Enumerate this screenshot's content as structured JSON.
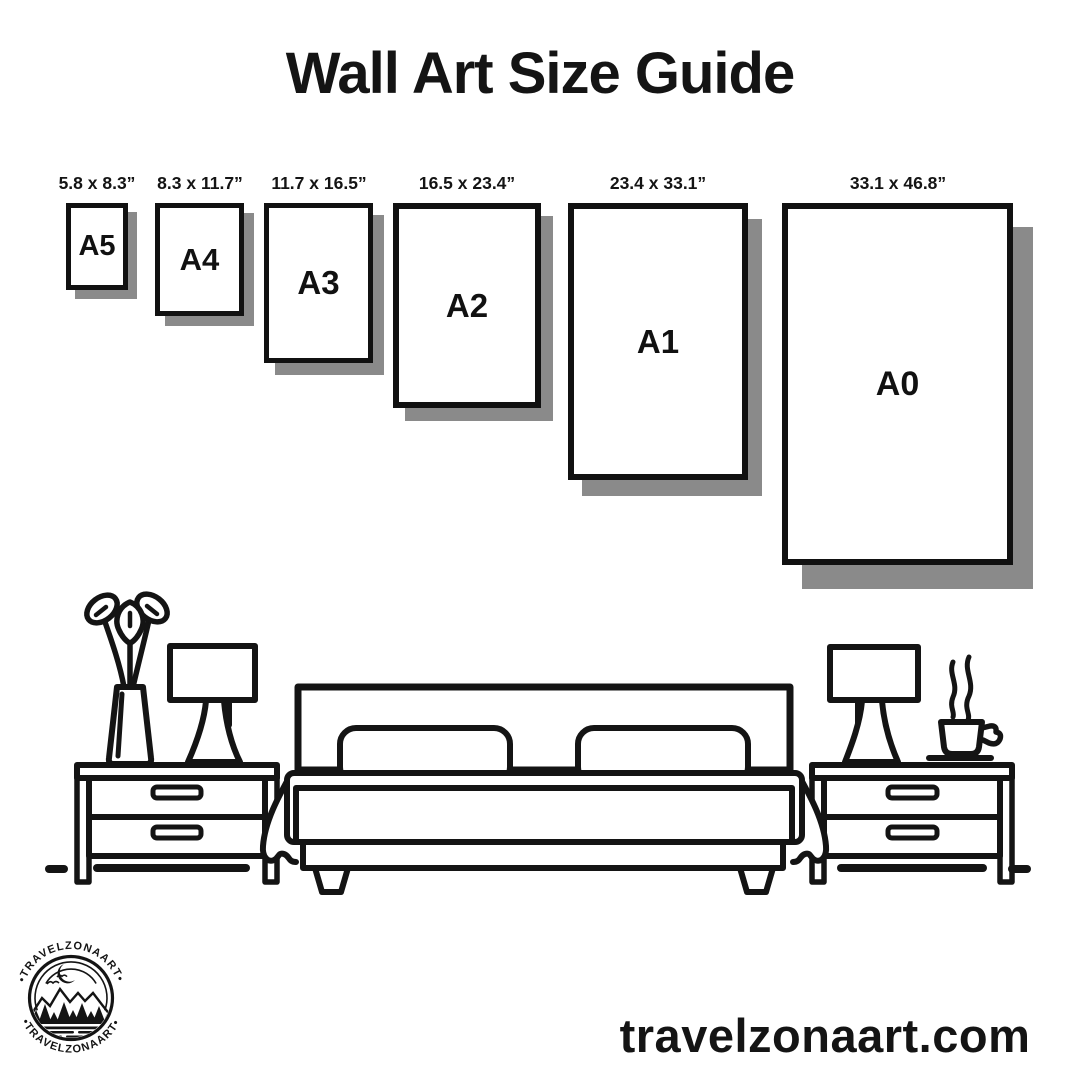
{
  "title": "Wall Art Size Guide",
  "sizes": [
    {
      "code": "A5",
      "dimensions": "5.8 x 8.3”"
    },
    {
      "code": "A4",
      "dimensions": "8.3 x 11.7”"
    },
    {
      "code": "A3",
      "dimensions": "11.7 x 16.5”"
    },
    {
      "code": "A2",
      "dimensions": "16.5 x 23.4”"
    },
    {
      "code": "A1",
      "dimensions": "23.4 x 33.1”"
    },
    {
      "code": "A0",
      "dimensions": "33.1 x 46.8”"
    }
  ],
  "scene": {
    "icons": [
      "vase-with-flowers-icon",
      "table-lamp-icon",
      "nightstand-icon",
      "double-bed-icon",
      "coffee-cup-icon"
    ]
  },
  "logo": {
    "brand_arc_top": "•TRAVELZONAART•",
    "brand_arc_bottom": "•TRAVELZONAART•"
  },
  "footer": {
    "website": "travelzonaart.com"
  },
  "colors": {
    "ink": "#141414",
    "shadow": "#8a8a8a",
    "background": "#ffffff"
  }
}
